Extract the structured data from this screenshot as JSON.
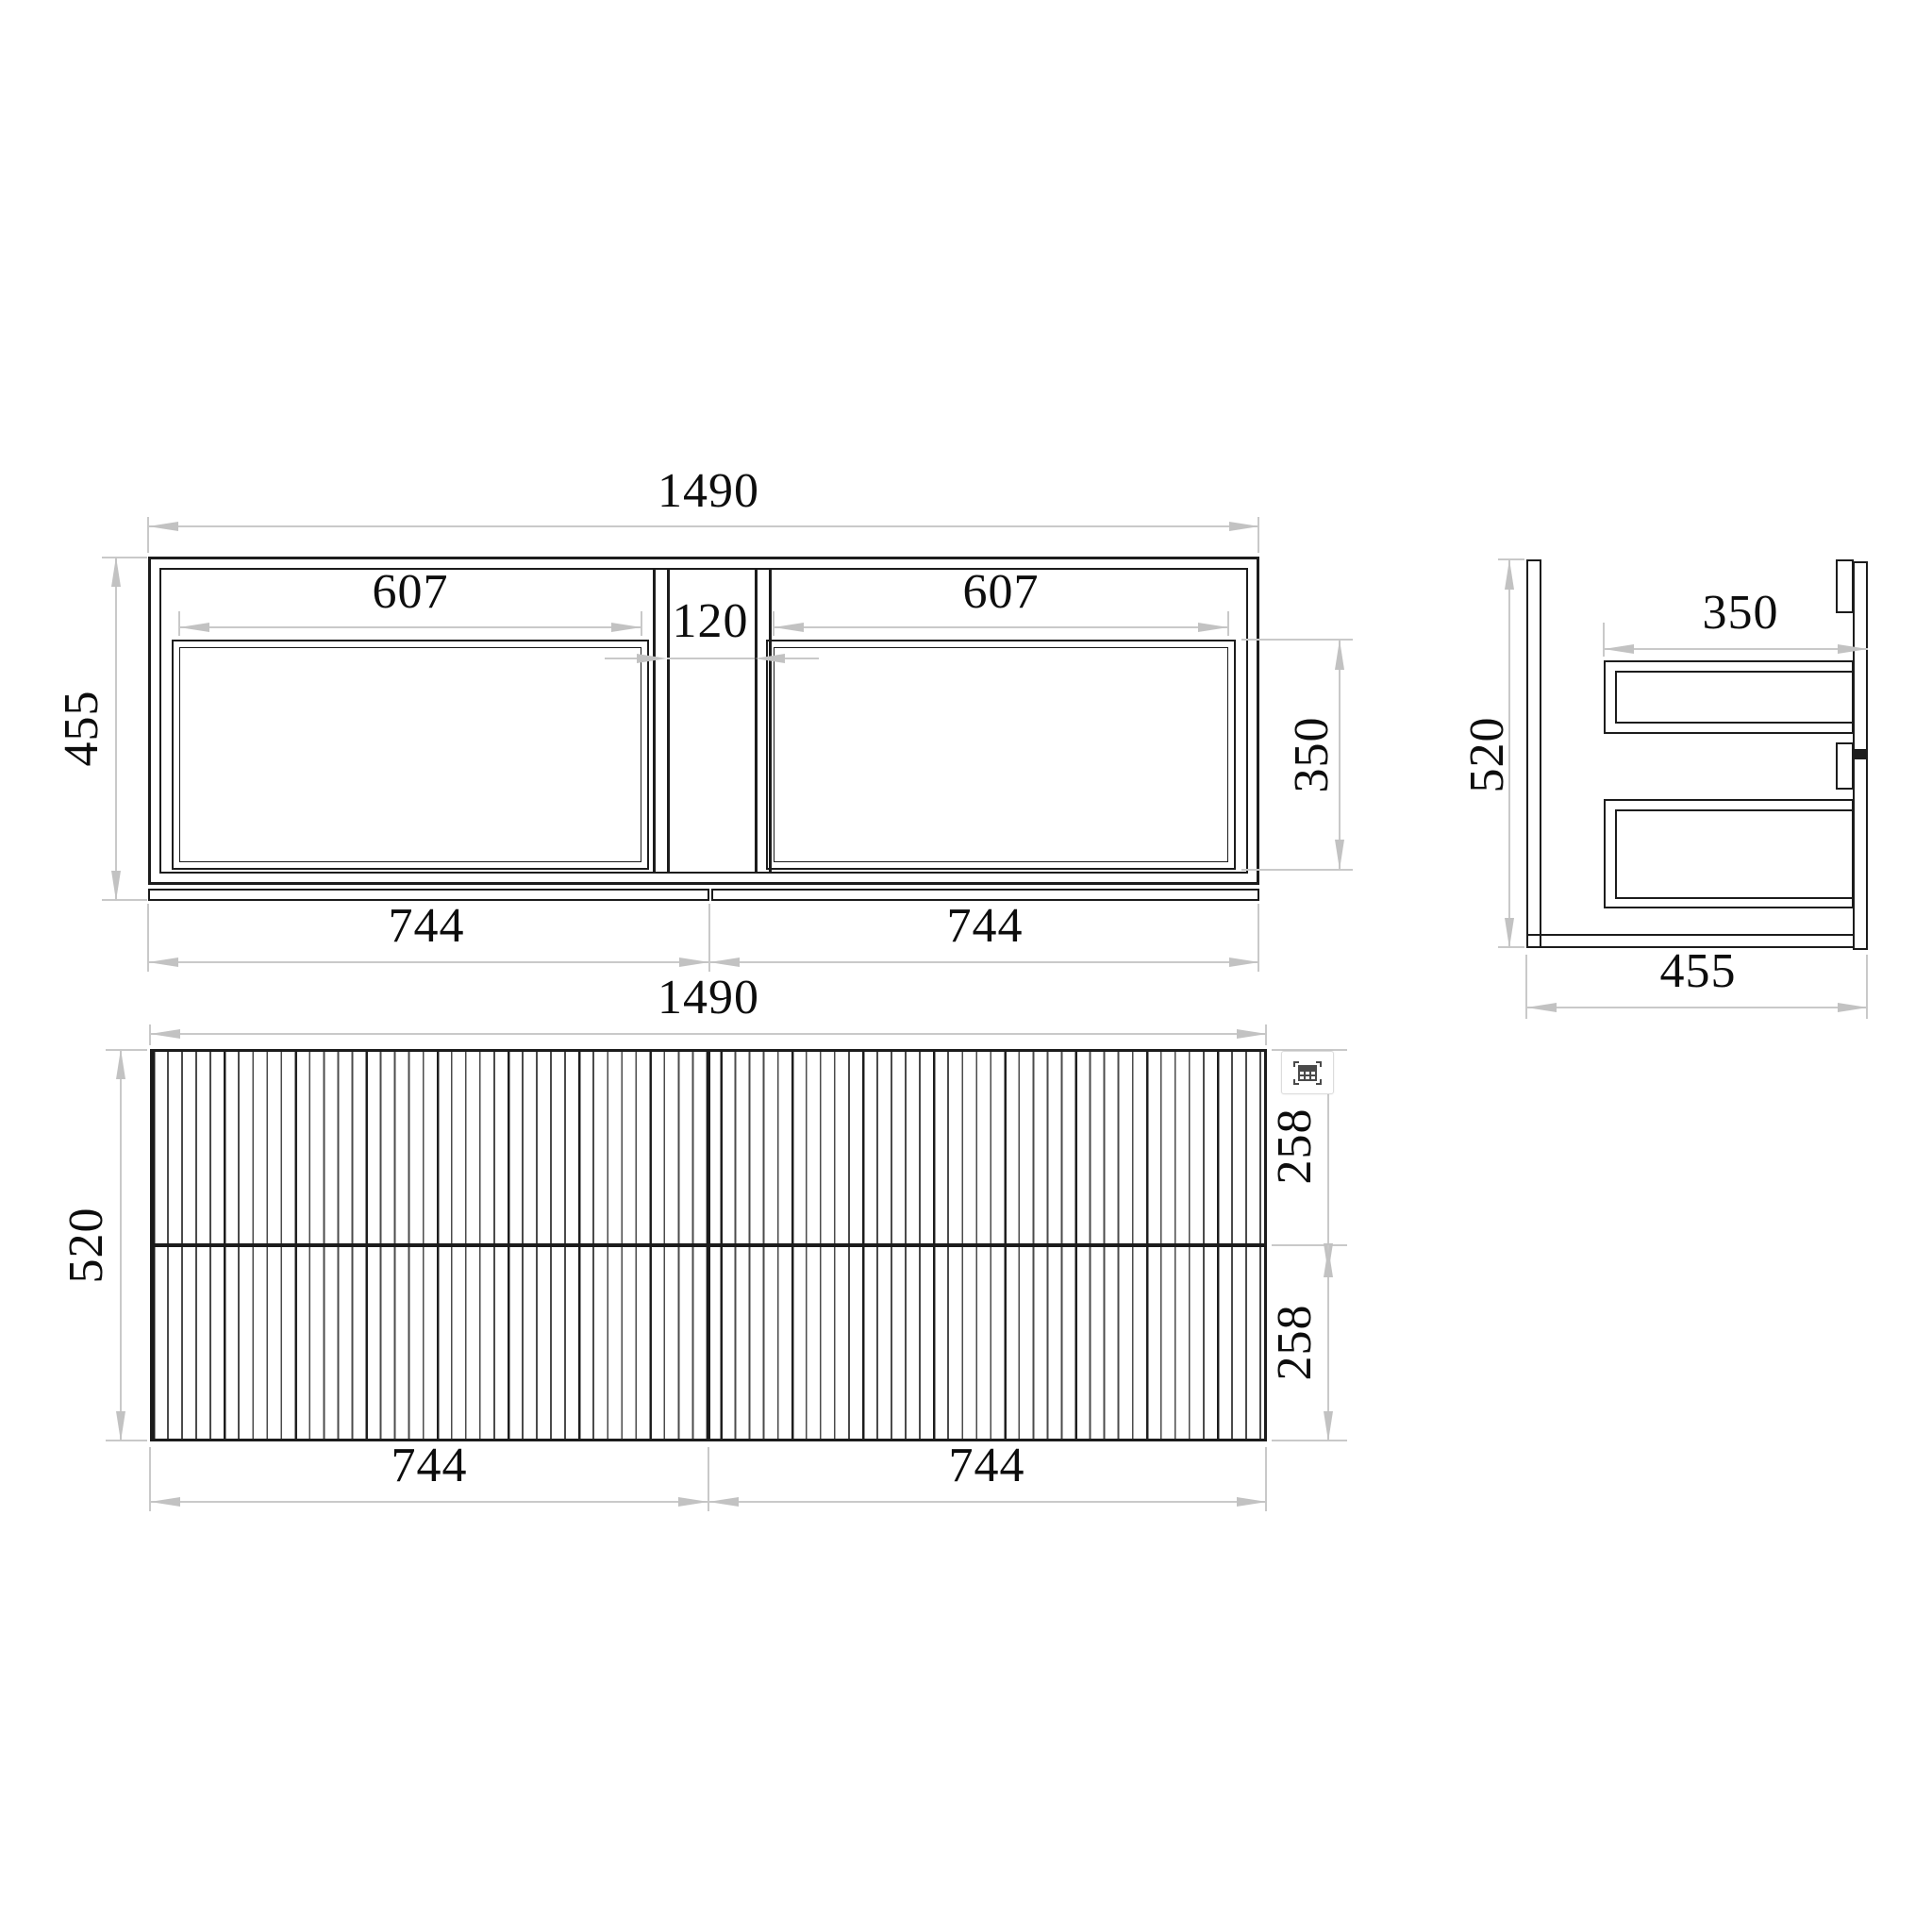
{
  "plan": {
    "width": "1490",
    "cutout_left": "607",
    "center_gap": "120",
    "cutout_right": "607",
    "depth": "455",
    "cutout_depth": "350",
    "front_left": "744",
    "front_right": "744"
  },
  "side": {
    "height": "520",
    "drawer_depth": "350",
    "depth": "455"
  },
  "front": {
    "width": "1490",
    "height": "520",
    "upper_drawer": "258",
    "lower_drawer": "258",
    "door_left": "744",
    "door_right": "744"
  },
  "icons": {
    "table_grid": "table-grid-icon"
  },
  "colors": {
    "geometry_line": "#1c1c1c",
    "dimension_line": "#c9c9c9",
    "arrow": "#c2c2c2",
    "text": "#0d0d0d",
    "background": "#ffffff"
  }
}
